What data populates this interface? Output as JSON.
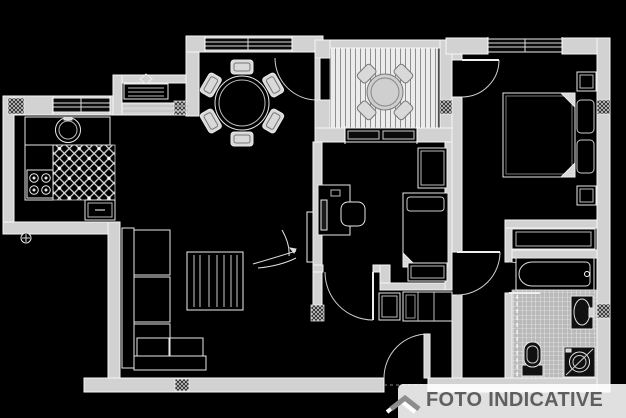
{
  "watermark": {
    "text": "FOTO INDICATIVE",
    "logo_icon": "roof-chevron-icon",
    "text_color": "#5f5f5f",
    "logo_color": "#8d8d8d",
    "box_color": "rgba(255,255,255,0.88)"
  },
  "drawing": {
    "type": "floor-plan",
    "style": "CAD line drawing, light walls and white furniture outlines on black background",
    "background_color": "#000000",
    "wall_fill": "#d2d2d2",
    "line_color": "#eeeeee",
    "rooms": [
      {
        "name": "kitchen",
        "position": "top-left",
        "fixtures": [
          "round-sink",
          "stove-4-burners",
          "counters",
          "diagonal-tiled-floor",
          "window",
          "gas-valve"
        ]
      },
      {
        "name": "living-dining-room",
        "position": "center-left",
        "fixtures": [
          "round-dining-table",
          "six-chairs",
          "radiator-with-valve",
          "corner-sofa",
          "striped-tv-cabinet",
          "wall-tv-panel",
          "plant",
          "window"
        ]
      },
      {
        "name": "balcony",
        "position": "top-center",
        "fixtures": [
          "round-table",
          "four-chairs",
          "decking-striped-floor",
          "door-to-living-room"
        ]
      },
      {
        "name": "bedroom-2",
        "position": "center",
        "fixtures": [
          "single-bed",
          "wardrobe",
          "nightstand",
          "desk",
          "computer-monitor",
          "desk-chair",
          "window-to-balcony",
          "door-to-hallway"
        ]
      },
      {
        "name": "main-bedroom",
        "position": "top-right",
        "fixtures": [
          "double-bed",
          "two-pillows",
          "two-nightstands",
          "built-in-closet",
          "window",
          "door"
        ]
      },
      {
        "name": "bathroom",
        "position": "bottom-right",
        "fixtures": [
          "bathtub",
          "washbasin",
          "toilet",
          "washing-machine",
          "fine-tiled-floor",
          "shower-screen-dashed",
          "door"
        ]
      },
      {
        "name": "hallway",
        "position": "bottom-center",
        "fixtures": [
          "entry-door",
          "shoe-cabinet",
          "dresser",
          "door-to-corridor"
        ]
      }
    ]
  }
}
